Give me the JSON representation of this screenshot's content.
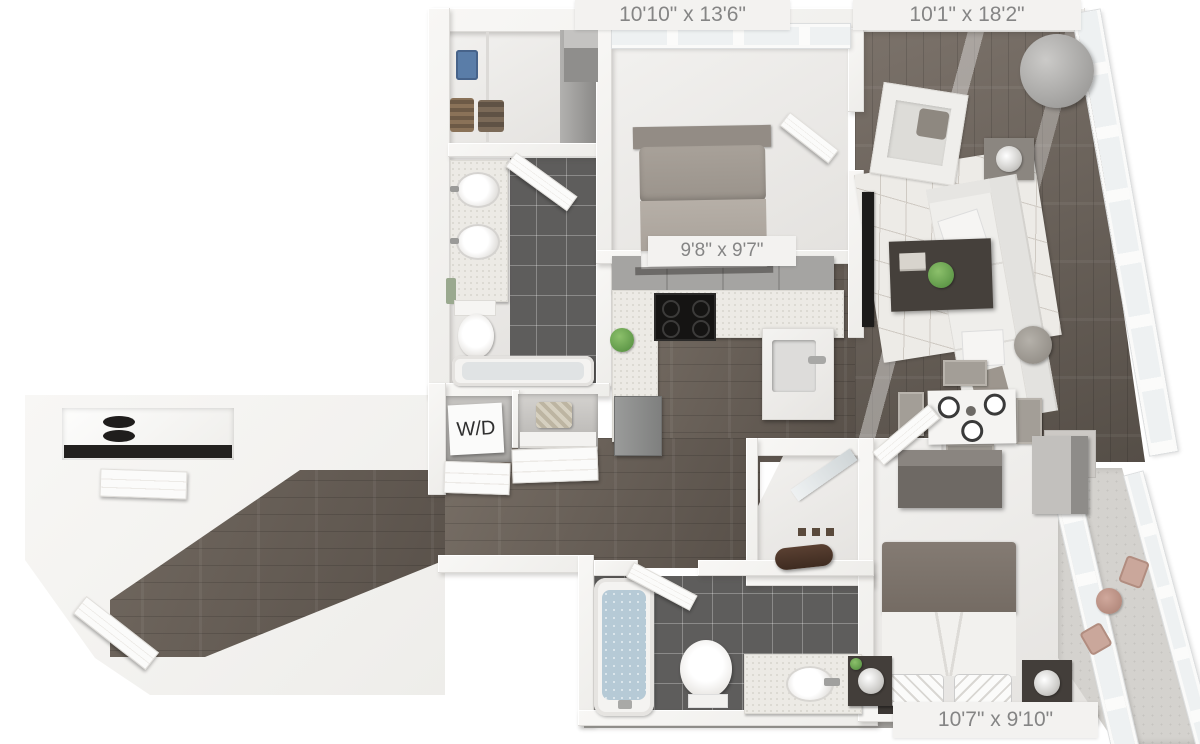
{
  "floorplan": {
    "labels": {
      "bedroom_top": "10'10\" x 13'6\"",
      "living_room": "10'1\" x 18'2\"",
      "kitchen": "9'8\" x 9'7\"",
      "bedroom_bottom": "10'7\" x 9'10\"",
      "washer_dryer": "W/D"
    },
    "colors": {
      "wall": "#f5f4f2",
      "wood_floor": "#675f58",
      "tile_floor": "#5e5d5c",
      "label_text": "#858585",
      "water": "#b6cad6",
      "plant": "#5e9c49"
    }
  }
}
